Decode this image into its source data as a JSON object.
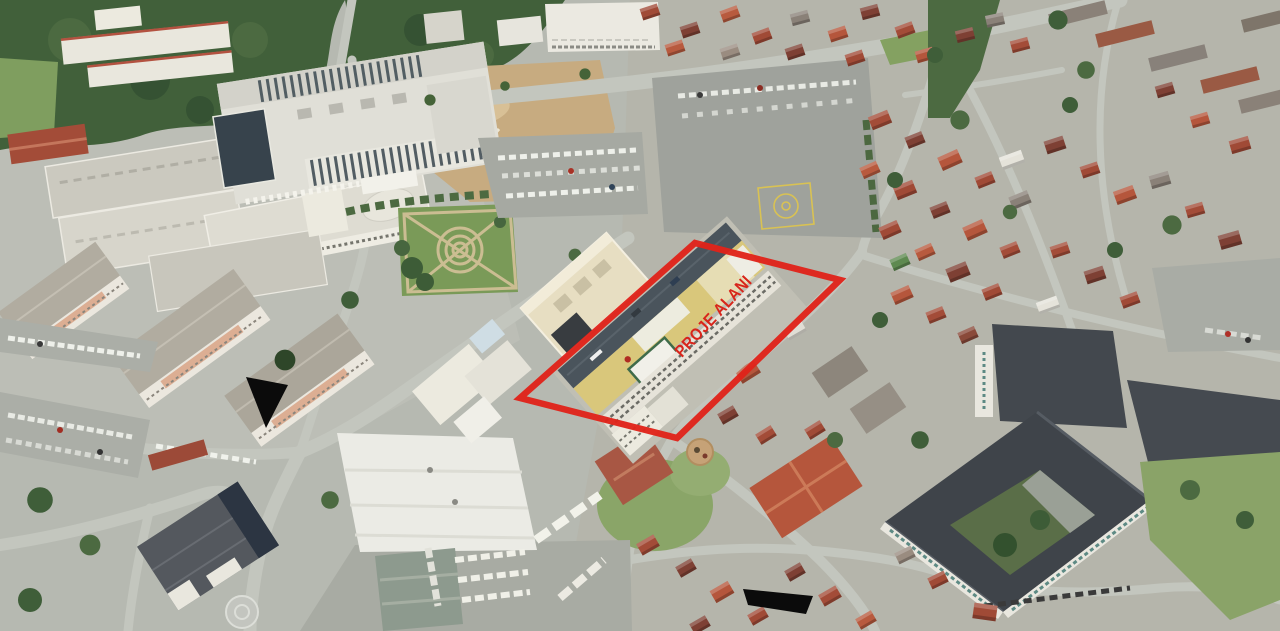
{
  "image": {
    "kind": "aerial-drone-photograph",
    "annotation": {
      "label": "PROJE ALANI",
      "outline_color": "#e0231a",
      "label_color": "#d8251b",
      "shape": "parallelogram",
      "marker_color": "#0b0b0b"
    },
    "palette": {
      "asphalt": "#b6b9b1",
      "road": "#c3c6be",
      "tree_dark": "#3f5e39",
      "tree_mid": "#4c6a41",
      "grass": "#86a262",
      "dirt": "#c7ab80",
      "roof_red_dark": "#7e4034",
      "roof_red": "#a34c38",
      "roof_terracotta": "#b8543a",
      "white_building": "#eceae2",
      "school_roof": "#3f444a",
      "glass_dark": "#37434c",
      "khaki_roof": "#d9c77b",
      "cream_roof": "#e7dec2",
      "helipad_yellow": "#d9c253"
    }
  }
}
